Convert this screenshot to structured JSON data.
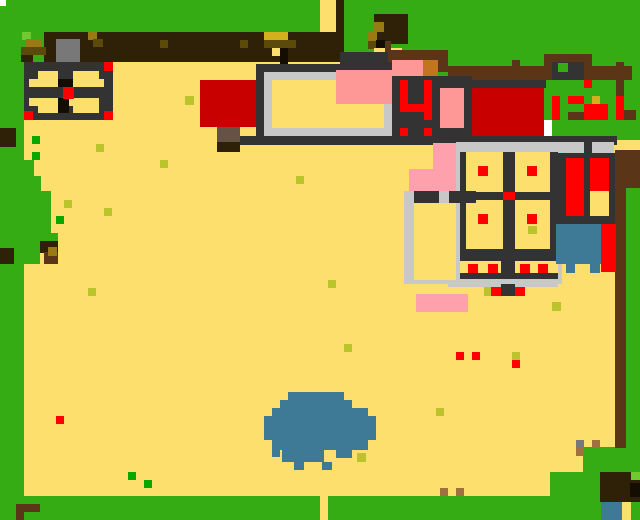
{
  "app": {
    "name": "pixel-town-world-map",
    "type": "game-overworld-map"
  },
  "canvas": {
    "width": 640,
    "height": 520,
    "background": "#35ac14"
  },
  "palette": {
    "grass": "#35ac14",
    "grassLight": "#6fc92f",
    "sand": "#fcdf6d",
    "wallDark": "#2f2107",
    "brown": "#5a3517",
    "doorBrown": "#655244",
    "grayBrown": "#645143",
    "gray": "#787878",
    "silver": "#c8c8c8",
    "dark": "#333333",
    "black": "#140d02",
    "red": "#fe0000",
    "darkRed": "#c80000",
    "salmon": "#fd9896",
    "pink": "#ffa0ad",
    "orange": "#c4731f",
    "teal": "#3e7995",
    "mustard": "#d4af1e",
    "gold": "#9a7a15",
    "olive": "#5c4a0a",
    "yg": "#bdc32c",
    "greenDot": "#08a800",
    "tan": "#a0713f",
    "white": "#ffffff"
  },
  "map_rects": [
    [
      320,
      0,
      16,
      62,
      "sand"
    ],
    [
      336,
      0,
      8,
      62,
      "wallDark"
    ],
    [
      24,
      62,
      368,
      82,
      "sand"
    ],
    [
      24,
      144,
      593,
      352,
      "sand"
    ],
    [
      617,
      140,
      23,
      12,
      "sand"
    ],
    [
      24,
      160,
      10,
      16,
      "grass"
    ],
    [
      24,
      176,
      17,
      15,
      "grass"
    ],
    [
      24,
      191,
      27,
      42,
      "grass"
    ],
    [
      24,
      233,
      34,
      16,
      "grass"
    ],
    [
      24,
      249,
      16,
      15,
      "grass"
    ],
    [
      583,
      447,
      57,
      50,
      "grass"
    ],
    [
      550,
      472,
      90,
      25,
      "grass"
    ],
    [
      0,
      496,
      640,
      24,
      "grass"
    ],
    [
      320,
      496,
      8,
      24,
      "sand"
    ],
    [
      0,
      128,
      16,
      19,
      "wallDark"
    ],
    [
      0,
      248,
      14,
      16,
      "wallDark"
    ],
    [
      40,
      241,
      18,
      12,
      "wallDark"
    ],
    [
      44,
      252,
      14,
      12,
      "brown"
    ],
    [
      48,
      247,
      9,
      9,
      "gold"
    ],
    [
      44,
      32,
      292,
      30,
      "wallDark"
    ],
    [
      22,
      32,
      9,
      8,
      "grassLight"
    ],
    [
      26,
      39,
      15,
      8,
      "gold"
    ],
    [
      21,
      47,
      25,
      8,
      "olive"
    ],
    [
      21,
      55,
      12,
      7,
      "wallDark"
    ],
    [
      41,
      62,
      6,
      7,
      "black"
    ],
    [
      88,
      32,
      9,
      8,
      "gold"
    ],
    [
      93,
      39,
      10,
      8,
      "olive"
    ],
    [
      160,
      40,
      8,
      8,
      "olive"
    ],
    [
      240,
      40,
      8,
      8,
      "olive"
    ],
    [
      264,
      32,
      24,
      8,
      "mustard"
    ],
    [
      264,
      40,
      32,
      8,
      "olive"
    ],
    [
      272,
      48,
      8,
      8,
      "sand"
    ],
    [
      280,
      48,
      8,
      16,
      "black"
    ],
    [
      56,
      39,
      24,
      25,
      "gray"
    ],
    [
      56,
      64,
      24,
      8,
      "grayBrown"
    ],
    [
      24,
      62,
      89,
      58,
      "dark"
    ],
    [
      38,
      71,
      20,
      8,
      "sand"
    ],
    [
      29,
      79,
      29,
      8,
      "sand"
    ],
    [
      73,
      71,
      26,
      8,
      "sand"
    ],
    [
      73,
      79,
      31,
      8,
      "sand"
    ],
    [
      29,
      98,
      29,
      8,
      "sand"
    ],
    [
      38,
      106,
      20,
      7,
      "sand"
    ],
    [
      69,
      98,
      30,
      8,
      "sand"
    ],
    [
      73,
      106,
      26,
      7,
      "sand"
    ],
    [
      58,
      79,
      15,
      8,
      "black"
    ],
    [
      58,
      98,
      11,
      15,
      "black"
    ],
    [
      29,
      87,
      75,
      11,
      "dark"
    ],
    [
      63,
      87,
      11,
      12,
      "red"
    ],
    [
      104,
      62,
      9,
      9,
      "red"
    ],
    [
      24,
      111,
      9,
      9,
      "red"
    ],
    [
      104,
      111,
      9,
      9,
      "red"
    ],
    [
      374,
      14,
      34,
      30,
      "wallDark"
    ],
    [
      374,
      22,
      10,
      10,
      "gold"
    ],
    [
      368,
      32,
      9,
      9,
      "gold"
    ],
    [
      368,
      41,
      9,
      8,
      "olive"
    ],
    [
      376,
      40,
      10,
      10,
      "black"
    ],
    [
      385,
      41,
      6,
      15,
      "brown"
    ],
    [
      374,
      48,
      11,
      9,
      "sand"
    ],
    [
      391,
      48,
      11,
      9,
      "sand"
    ],
    [
      340,
      52,
      53,
      20,
      "dark"
    ],
    [
      388,
      50,
      60,
      12,
      "brown"
    ],
    [
      436,
      60,
      12,
      12,
      "brown"
    ],
    [
      448,
      66,
      184,
      14,
      "brown"
    ],
    [
      512,
      60,
      8,
      8,
      "brown"
    ],
    [
      544,
      54,
      48,
      10,
      "brown"
    ],
    [
      544,
      54,
      8,
      26,
      "brown"
    ],
    [
      584,
      54,
      8,
      26,
      "brown"
    ],
    [
      552,
      62,
      32,
      18,
      "dark"
    ],
    [
      558,
      63,
      10,
      9,
      "grass"
    ],
    [
      616,
      62,
      8,
      34,
      "brown"
    ],
    [
      624,
      110,
      12,
      10,
      "brown"
    ],
    [
      616,
      96,
      8,
      24,
      "red"
    ],
    [
      584,
      80,
      8,
      8,
      "red"
    ],
    [
      552,
      96,
      8,
      24,
      "red"
    ],
    [
      568,
      96,
      16,
      8,
      "red"
    ],
    [
      568,
      112,
      16,
      8,
      "brown"
    ],
    [
      584,
      104,
      24,
      16,
      "red"
    ],
    [
      592,
      96,
      8,
      8,
      "mustard"
    ],
    [
      200,
      80,
      58,
      47,
      "darkRed"
    ],
    [
      217,
      127,
      23,
      16,
      "doorBrown"
    ],
    [
      217,
      142,
      23,
      10,
      "wallDark"
    ],
    [
      256,
      64,
      136,
      8,
      "dark"
    ],
    [
      256,
      64,
      9,
      78,
      "dark"
    ],
    [
      264,
      72,
      128,
      64,
      "silver"
    ],
    [
      272,
      80,
      112,
      48,
      "sand"
    ],
    [
      336,
      70,
      56,
      34,
      "salmon"
    ],
    [
      392,
      60,
      31,
      16,
      "salmon"
    ],
    [
      423,
      60,
      15,
      16,
      "orange"
    ],
    [
      392,
      76,
      80,
      60,
      "dark"
    ],
    [
      400,
      80,
      8,
      32,
      "red"
    ],
    [
      400,
      104,
      32,
      8,
      "red"
    ],
    [
      424,
      80,
      8,
      40,
      "red"
    ],
    [
      400,
      128,
      8,
      8,
      "red"
    ],
    [
      424,
      128,
      8,
      8,
      "red"
    ],
    [
      440,
      88,
      24,
      40,
      "salmon"
    ],
    [
      472,
      80,
      74,
      8,
      "dark"
    ],
    [
      472,
      88,
      72,
      48,
      "darkRed"
    ],
    [
      544,
      120,
      8,
      16,
      "white"
    ],
    [
      240,
      136,
      377,
      9,
      "dark"
    ],
    [
      456,
      142,
      158,
      11,
      "silver"
    ],
    [
      584,
      142,
      8,
      11,
      "dark"
    ],
    [
      456,
      142,
      8,
      68,
      "silver"
    ],
    [
      554,
      153,
      8,
      131,
      "silver"
    ],
    [
      460,
      152,
      98,
      132,
      "dark"
    ],
    [
      466,
      152,
      37,
      40,
      "sand"
    ],
    [
      515,
      152,
      35,
      40,
      "sand"
    ],
    [
      466,
      200,
      37,
      49,
      "sand"
    ],
    [
      515,
      200,
      35,
      49,
      "sand"
    ],
    [
      478,
      166,
      10,
      10,
      "red"
    ],
    [
      527,
      166,
      10,
      10,
      "red"
    ],
    [
      503,
      192,
      12,
      8,
      "red"
    ],
    [
      478,
      214,
      10,
      10,
      "red"
    ],
    [
      527,
      214,
      10,
      10,
      "red"
    ],
    [
      528,
      226,
      9,
      8,
      "yg"
    ],
    [
      460,
      261,
      41,
      12,
      "sand"
    ],
    [
      515,
      261,
      43,
      12,
      "sand"
    ],
    [
      468,
      264,
      10,
      9,
      "red"
    ],
    [
      488,
      264,
      10,
      9,
      "red"
    ],
    [
      520,
      264,
      10,
      9,
      "red"
    ],
    [
      538,
      264,
      10,
      9,
      "red"
    ],
    [
      448,
      279,
      110,
      8,
      "silver"
    ],
    [
      501,
      284,
      14,
      12,
      "dark"
    ],
    [
      484,
      287,
      8,
      9,
      "yg"
    ],
    [
      491,
      287,
      10,
      9,
      "red"
    ],
    [
      515,
      287,
      10,
      9,
      "red"
    ],
    [
      404,
      191,
      56,
      93,
      "silver"
    ],
    [
      414,
      191,
      62,
      12,
      "dark"
    ],
    [
      439,
      191,
      10,
      12,
      "silver"
    ],
    [
      414,
      203,
      42,
      77,
      "sand"
    ],
    [
      433,
      143,
      23,
      26,
      "pink"
    ],
    [
      409,
      169,
      47,
      22,
      "pink"
    ],
    [
      552,
      153,
      65,
      71,
      "dark"
    ],
    [
      566,
      158,
      18,
      58,
      "red"
    ],
    [
      590,
      158,
      19,
      33,
      "red"
    ],
    [
      590,
      191,
      19,
      25,
      "sand"
    ],
    [
      615,
      150,
      25,
      38,
      "brown"
    ],
    [
      615,
      188,
      11,
      260,
      "brown"
    ],
    [
      556,
      224,
      45,
      40,
      "teal"
    ],
    [
      566,
      264,
      9,
      9,
      "teal"
    ],
    [
      590,
      264,
      10,
      9,
      "teal"
    ],
    [
      601,
      224,
      15,
      48,
      "red"
    ],
    [
      416,
      294,
      52,
      18,
      "pink"
    ],
    [
      552,
      302,
      9,
      9,
      "yg"
    ],
    [
      288,
      392,
      56,
      8,
      "teal"
    ],
    [
      280,
      400,
      72,
      8,
      "teal"
    ],
    [
      272,
      408,
      96,
      8,
      "teal"
    ],
    [
      264,
      416,
      112,
      24,
      "teal"
    ],
    [
      272,
      440,
      96,
      10,
      "teal"
    ],
    [
      282,
      450,
      42,
      12,
      "teal"
    ],
    [
      336,
      450,
      16,
      8,
      "teal"
    ],
    [
      294,
      462,
      10,
      8,
      "teal"
    ],
    [
      322,
      462,
      10,
      8,
      "teal"
    ],
    [
      272,
      448,
      8,
      9,
      "teal"
    ],
    [
      357,
      453,
      9,
      9,
      "yg"
    ],
    [
      600,
      472,
      40,
      30,
      "wallDark"
    ],
    [
      630,
      483,
      10,
      14,
      "black"
    ],
    [
      631,
      472,
      9,
      8,
      "grassLight"
    ],
    [
      601,
      502,
      21,
      18,
      "teal"
    ],
    [
      622,
      502,
      9,
      18,
      "sand"
    ],
    [
      16,
      504,
      24,
      8,
      "brown"
    ],
    [
      16,
      512,
      8,
      8,
      "brown"
    ],
    [
      185,
      96,
      9,
      9,
      "yg"
    ],
    [
      96,
      144,
      8,
      8,
      "yg"
    ],
    [
      160,
      160,
      8,
      8,
      "yg"
    ],
    [
      64,
      200,
      8,
      8,
      "yg"
    ],
    [
      104,
      208,
      8,
      8,
      "yg"
    ],
    [
      296,
      176,
      8,
      8,
      "yg"
    ],
    [
      88,
      288,
      8,
      8,
      "yg"
    ],
    [
      328,
      280,
      8,
      8,
      "yg"
    ],
    [
      344,
      344,
      8,
      8,
      "yg"
    ],
    [
      512,
      352,
      8,
      8,
      "yg"
    ],
    [
      436,
      408,
      8,
      8,
      "yg"
    ],
    [
      32,
      136,
      8,
      8,
      "greenDot"
    ],
    [
      32,
      152,
      8,
      8,
      "greenDot"
    ],
    [
      56,
      216,
      8,
      8,
      "greenDot"
    ],
    [
      128,
      472,
      8,
      8,
      "greenDot"
    ],
    [
      144,
      480,
      8,
      8,
      "greenDot"
    ],
    [
      56,
      416,
      8,
      8,
      "red"
    ],
    [
      456,
      352,
      8,
      8,
      "red"
    ],
    [
      472,
      352,
      8,
      8,
      "red"
    ],
    [
      512,
      360,
      8,
      8,
      "red"
    ],
    [
      440,
      488,
      8,
      8,
      "tan"
    ],
    [
      456,
      488,
      8,
      8,
      "tan"
    ],
    [
      592,
      440,
      8,
      8,
      "tan"
    ],
    [
      576,
      448,
      8,
      8,
      "tan"
    ],
    [
      576,
      440,
      8,
      8,
      "gray"
    ],
    [
      0,
      0,
      6,
      6,
      "white"
    ]
  ],
  "landmarks": [
    {
      "name": "windmill-lodge",
      "x": 24,
      "y": 62,
      "w": 89,
      "h": 58
    },
    {
      "name": "north-wall",
      "x": 44,
      "y": 32,
      "w": 292,
      "h": 30
    },
    {
      "name": "gate-statue",
      "x": 56,
      "y": 39,
      "w": 24,
      "h": 33
    },
    {
      "name": "chimney-path-north",
      "x": 320,
      "y": 0,
      "w": 24,
      "h": 62
    },
    {
      "name": "red-shop-west",
      "x": 200,
      "y": 80,
      "w": 58,
      "h": 72
    },
    {
      "name": "town-hall",
      "x": 256,
      "y": 64,
      "w": 136,
      "h": 80
    },
    {
      "name": "shop-41-sign",
      "x": 392,
      "y": 60,
      "w": 80,
      "h": 76
    },
    {
      "name": "red-shop-east",
      "x": 472,
      "y": 80,
      "w": 74,
      "h": 56
    },
    {
      "name": "north-sign",
      "x": 544,
      "y": 54,
      "w": 48,
      "h": 26
    },
    {
      "name": "fence-line",
      "x": 388,
      "y": 50,
      "w": 244,
      "h": 30
    },
    {
      "name": "flower-patch-ne",
      "x": 552,
      "y": 80,
      "w": 72,
      "h": 40
    },
    {
      "name": "main-road",
      "x": 240,
      "y": 136,
      "w": 377,
      "h": 9
    },
    {
      "name": "market-hall",
      "x": 456,
      "y": 142,
      "w": 158,
      "h": 145
    },
    {
      "name": "market-annex",
      "x": 404,
      "y": 191,
      "w": 60,
      "h": 93
    },
    {
      "name": "banner-stand",
      "x": 552,
      "y": 153,
      "w": 65,
      "h": 71
    },
    {
      "name": "small-pond",
      "x": 556,
      "y": 224,
      "w": 60,
      "h": 49
    },
    {
      "name": "large-pond",
      "x": 264,
      "y": 392,
      "w": 112,
      "h": 80
    },
    {
      "name": "west-tree",
      "x": 24,
      "y": 160,
      "w": 34,
      "h": 104
    },
    {
      "name": "north-tree",
      "x": 368,
      "y": 14,
      "w": 40,
      "h": 48
    },
    {
      "name": "southeast-house",
      "x": 600,
      "y": 472,
      "w": 40,
      "h": 48
    },
    {
      "name": "southwest-bench",
      "x": 16,
      "y": 504,
      "w": 24,
      "h": 16
    },
    {
      "name": "south-exit-path",
      "x": 320,
      "y": 496,
      "w": 8,
      "h": 24
    }
  ]
}
